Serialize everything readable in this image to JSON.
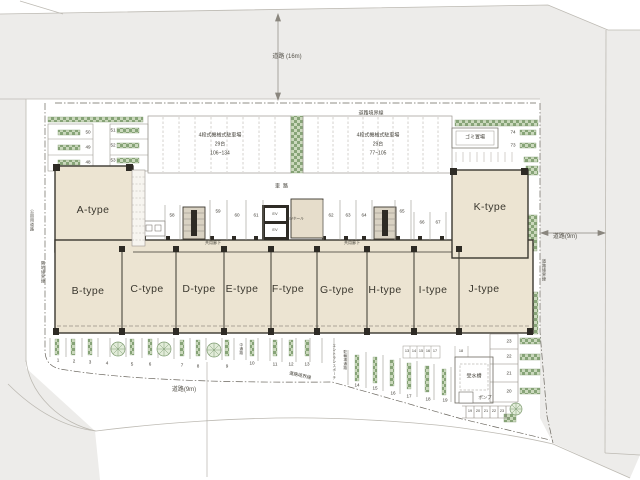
{
  "plan": {
    "roads": {
      "top": "道路 (16m)",
      "right": "道路(9m)",
      "bottom": "道路(9m)"
    },
    "boundaries": {
      "road_top": "道路境界線",
      "road_right": "道路境界線",
      "road_bottom": "道路境界線",
      "park_road": "公園用道路",
      "neighbor": "隣地境界線"
    },
    "driveway": "車路",
    "building": {
      "units": [
        "A-type",
        "B-type",
        "C-type",
        "D-type",
        "E-type",
        "F-type",
        "G-type",
        "H-type",
        "I-type",
        "J-type",
        "K-type"
      ],
      "corridor": "共用廊下",
      "ev": "EV",
      "ev_hall": "EVホール"
    },
    "facilities": {
      "garbage": "ゴミ置場",
      "water_tank": "受水槽",
      "pump": "ポンプ",
      "entrance_porch": "エントランスポーチ",
      "bike_passage": "駐輪場通路",
      "center_passage": "中通路"
    },
    "mech_parking_left": {
      "name": "4段式機械式駐車場",
      "count": "29台",
      "range": "106~134"
    },
    "mech_parking_right": {
      "name": "4段式機械式駐車場",
      "count": "29台",
      "range": "77~105"
    },
    "spots": {
      "northwest": [
        "50",
        "49",
        "48",
        "51",
        "52",
        "53"
      ],
      "center": [
        "58",
        "59",
        "60",
        "61",
        "62",
        "63",
        "64",
        "65",
        "66",
        "67"
      ],
      "east": [
        "74",
        "73"
      ],
      "south": [
        "1",
        "2",
        "3",
        "4",
        "5",
        "6",
        "7",
        "8",
        "9",
        "10",
        "11",
        "12",
        "13"
      ],
      "southeast": [
        "14",
        "15",
        "16",
        "17",
        "18",
        "19"
      ],
      "bike_row": [
        "13",
        "14",
        "15",
        "16",
        "17",
        "18"
      ],
      "east_column": [
        "23",
        "22",
        "21",
        "20"
      ],
      "southeast_small": [
        "19",
        "20",
        "21",
        "22",
        "23"
      ]
    },
    "colors": {
      "road": "#edecea",
      "building": "#ece4d2",
      "planting": "#9cba8e",
      "wall": "#332f28"
    }
  }
}
